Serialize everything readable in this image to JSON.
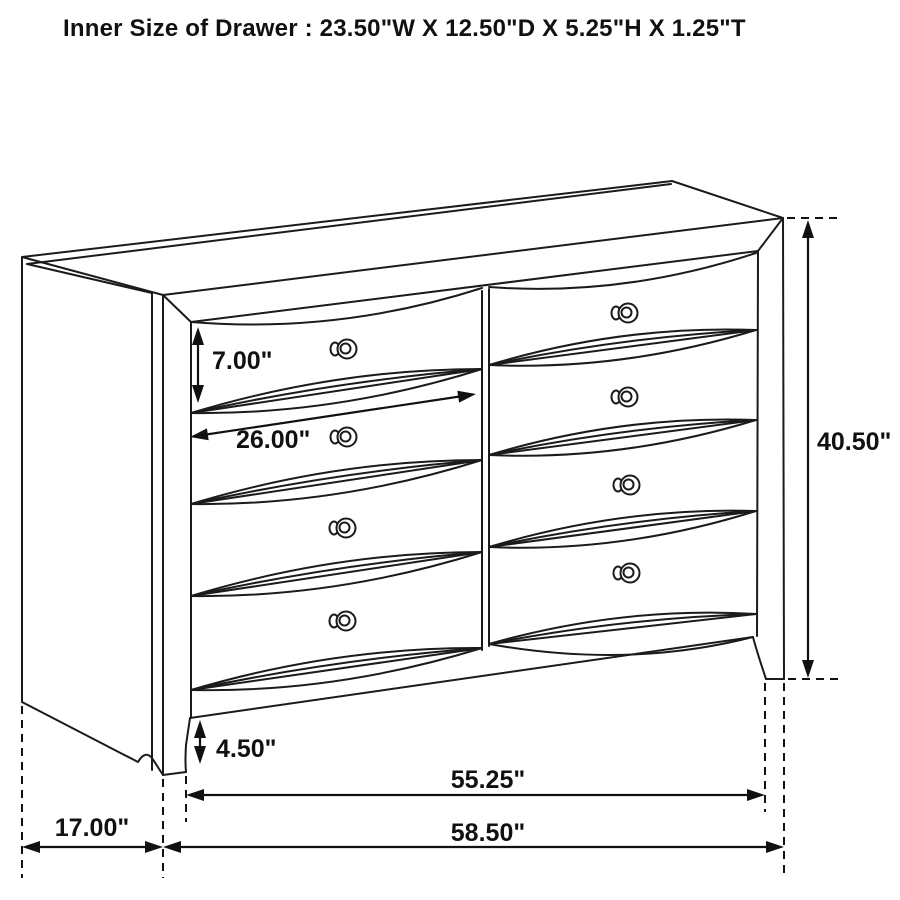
{
  "page": {
    "background": "#ffffff",
    "line_color": "#1b1b1b",
    "text_color": "#111111"
  },
  "title": "Inner Size of Drawer : 23.50\"W X 12.50\"D X 5.25\"H X 1.25\"T",
  "diagram": {
    "type": "furniture-dimension-drawing",
    "subject": "8-drawer dresser",
    "view": "three-quarter front perspective line drawing",
    "drawer_layout": {
      "columns": 2,
      "rows": 4,
      "total_drawers": 8
    },
    "dimensions": {
      "drawer_face_height": "7.00\"",
      "drawer_width": "26.00\"",
      "overall_height": "40.50\"",
      "base_height": "4.50\"",
      "front_width": "55.25\"",
      "overall_width": "58.50\"",
      "side_depth": "17.00\""
    },
    "inner_drawer_size": {
      "width": "23.50\"",
      "depth": "12.50\"",
      "height": "5.25\"",
      "thickness": "1.25\""
    }
  }
}
